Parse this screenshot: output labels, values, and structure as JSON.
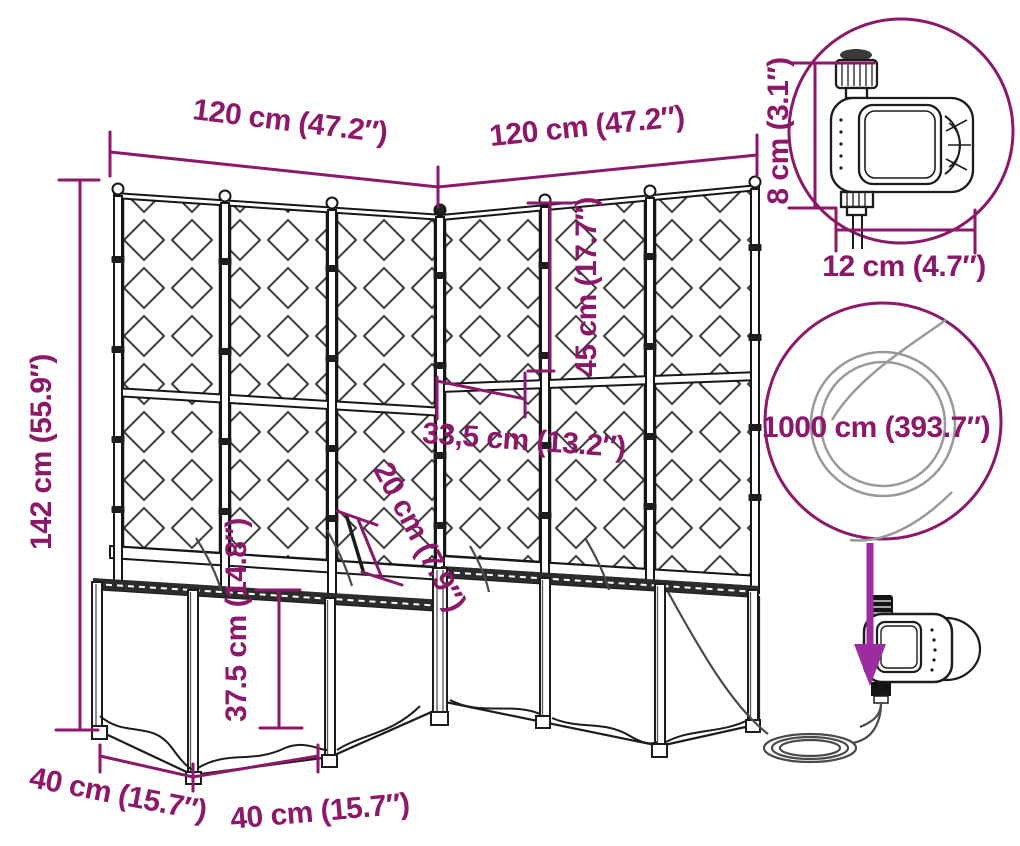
{
  "labels": {
    "width_left": "120 cm (47.2″)",
    "width_right": "120 cm (47.2″)",
    "overall_height": "142 cm (55.9″)",
    "upper_trellis_height": "45 cm (17.7″)",
    "post_spacing": "33,5 cm (13.2″)",
    "drip_spike_length": "20 cm (7.9″)",
    "planter_box_height": "37.5 cm (14.8″)",
    "footprint_depth": "40 cm (15.7″)",
    "footprint_width": "40 cm (15.7″)",
    "timer_height": "8 cm (3.1″)",
    "timer_width": "12 cm (4.7″)",
    "hose_length": "1000 cm (393.7″)"
  },
  "colors": {
    "dimension_accent": "#8d1768",
    "arrow_accent": "#9b2da0",
    "line_art": "#1c1c1c"
  }
}
